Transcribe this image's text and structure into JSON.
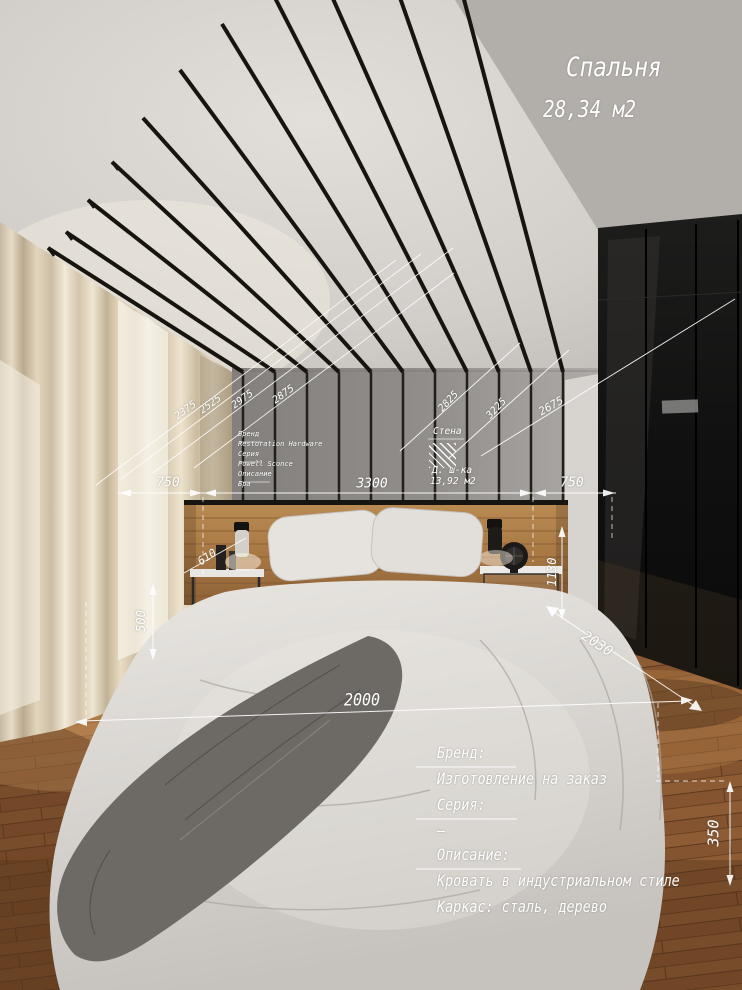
{
  "title": {
    "room": "Спальня",
    "area": "28,34 м2"
  },
  "sconce_block": {
    "brand_label": "Бренд",
    "brand": "Restoration Hardware",
    "series_label": "Серия",
    "series": "Powell Sconce",
    "description_label": "Описание",
    "description": "Бра"
  },
  "wall_block": {
    "label": "Стена",
    "material": "Д. ш-ка",
    "area": "13,92 м2"
  },
  "bed_block": {
    "brand_label": "Бренд:",
    "brand": "Изготовление на заказ",
    "series_label": "Серия:",
    "series": "–",
    "description_label": "Описание:",
    "description_line1": "Кровать в индустриальном стиле",
    "description_line2": "Каркас: сталь, дерево"
  },
  "dimensions": {
    "ceiling_left": [
      "2375",
      "2525",
      "2975",
      "2875"
    ],
    "ceiling_right": [
      "2825",
      "3225",
      "2675"
    ],
    "wall_segments": [
      "750",
      "3300",
      "750"
    ],
    "headboard_offset": "610",
    "nightstand_wall": "1130",
    "bed_side": "500",
    "bed_length": "2030",
    "bed_width": "2000",
    "wardrobe_floor": "350"
  },
  "colors": {
    "annotation": "#ffffff",
    "ceiling_beam": "#17140f",
    "wood_floor": "#8a5a33",
    "wardrobe": "#121212",
    "curtain": "#d9cbb4",
    "headboard_wood": "#b0804a"
  }
}
